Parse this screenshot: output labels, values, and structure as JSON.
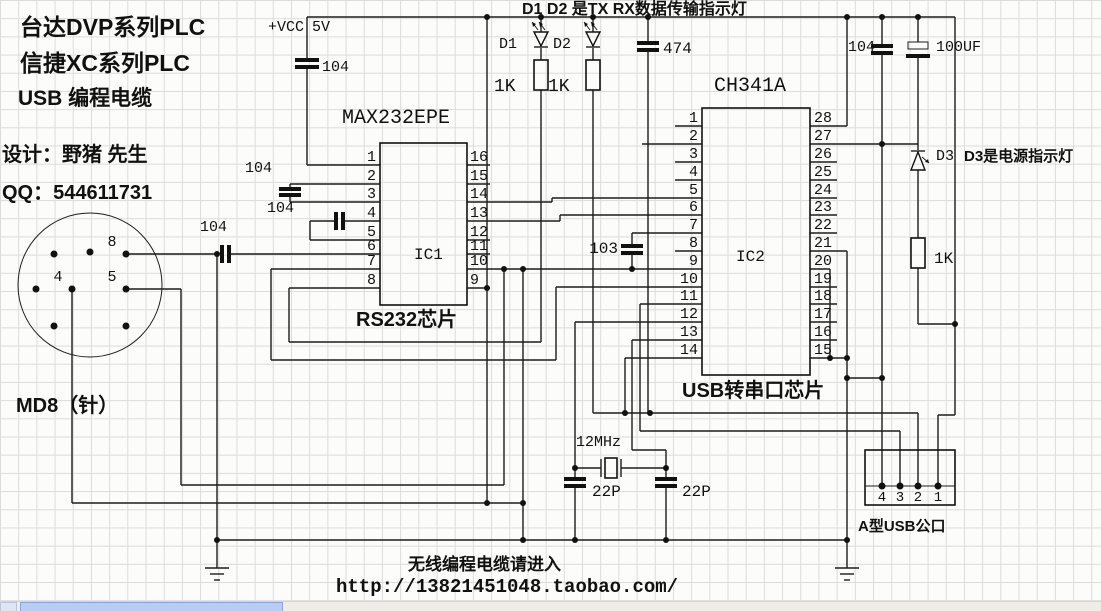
{
  "header": {
    "brand1": "台达DVP系列PLC",
    "brand2": "信捷XC系列PLC",
    "brand3": "USB  编程电缆",
    "designer": "设计：野猪 先生",
    "qq": "QQ：544611731"
  },
  "power": {
    "vcc": "+VCC",
    "v5": "5V"
  },
  "md8": {
    "label": "MD8（针）",
    "pin8": "8",
    "pin4": "4",
    "pin5": "5"
  },
  "ic1": {
    "title": "MAX232EPE",
    "name": "IC1",
    "caption": "RS232芯片",
    "pins_left": [
      "1",
      "2",
      "3",
      "4",
      "5",
      "6",
      "7",
      "8"
    ],
    "pins_right": [
      "16",
      "15",
      "14",
      "13",
      "12",
      "11",
      "10",
      "9"
    ]
  },
  "ic2": {
    "title": "CH341A",
    "name": "IC2",
    "caption": "USB转串口芯片",
    "pins_left": [
      "1",
      "2",
      "3",
      "4",
      "5",
      "6",
      "7",
      "8",
      "9",
      "10",
      "11",
      "12",
      "13",
      "14"
    ],
    "pins_right": [
      "28",
      "27",
      "26",
      "25",
      "24",
      "23",
      "22",
      "21",
      "20",
      "19",
      "18",
      "17",
      "16",
      "15"
    ]
  },
  "leds": {
    "top_note": "D1 D2 是TX RX数据传输指示灯",
    "d1": "D1",
    "d2": "D2",
    "d3": "D3",
    "d3_note": "D3是电源指示灯",
    "r1": "1K",
    "r2": "1K",
    "r3": "1K"
  },
  "caps": {
    "c_vcc": "104",
    "c_a": "104",
    "c_b": "104",
    "c_c": "104",
    "c_474": "474",
    "c_103": "103",
    "c_tr": "104",
    "c_100uf": "100UF",
    "c22_1": "22P",
    "c22_2": "22P"
  },
  "crystal": {
    "freq": "12MHz"
  },
  "usb": {
    "pin_a": "4",
    "pin_b": "3",
    "pin_c": "2",
    "pin_d": "1",
    "label": "A型USB公口"
  },
  "footer": {
    "line1": "无线编程电缆请进入",
    "line2": "http://13821451048.taobao.com/"
  },
  "colors": {
    "wire": "#1c1c1c",
    "grid": "#dcdcdc",
    "background": "#fcfcfa",
    "scroll_thumb": "#b9cdf3",
    "scroll_track": "#efede7"
  }
}
